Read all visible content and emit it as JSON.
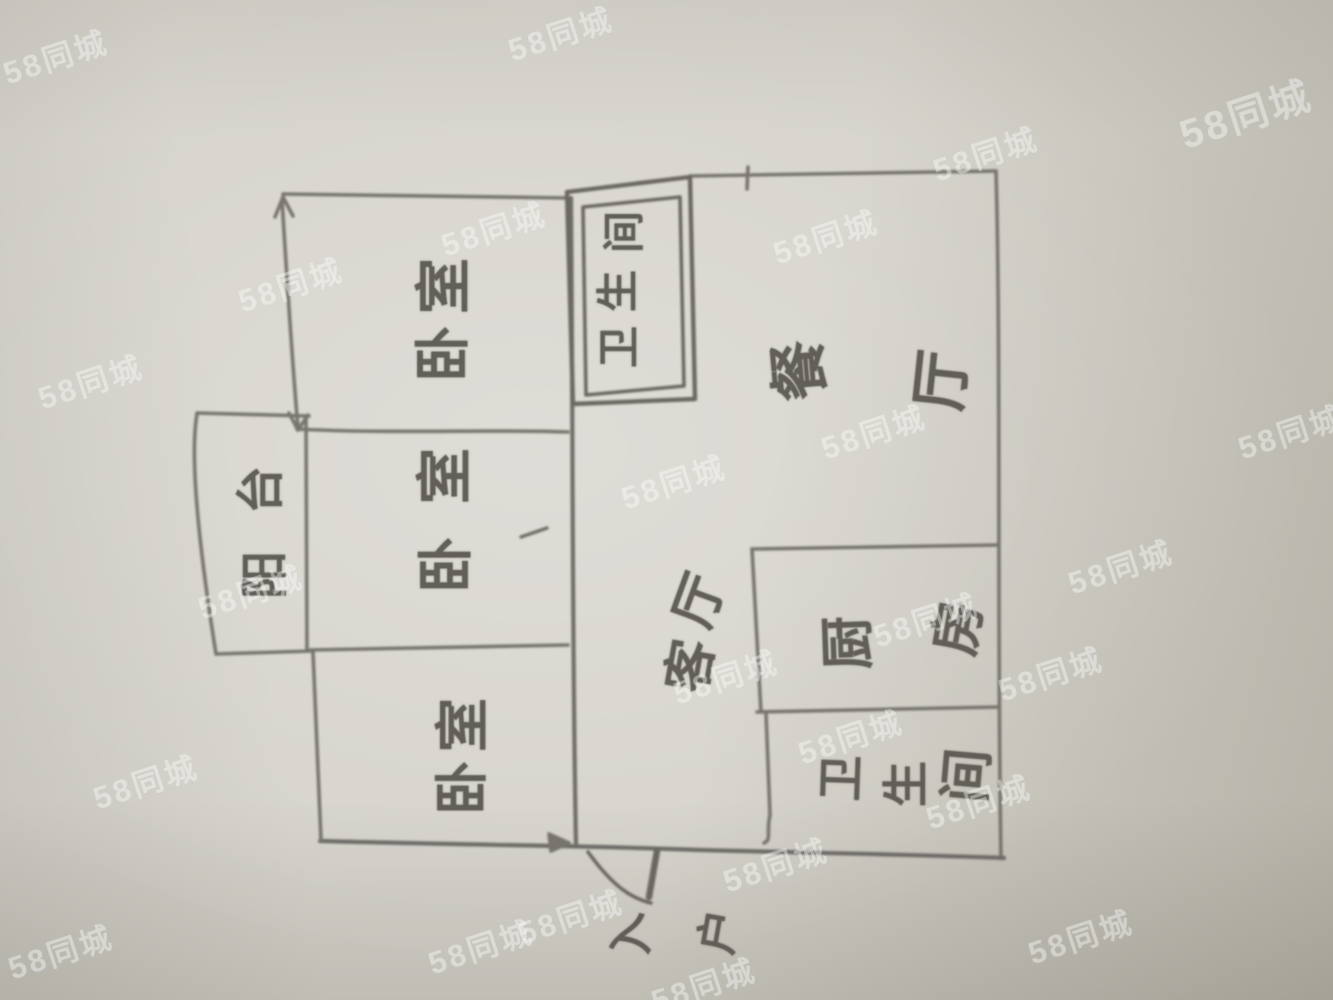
{
  "watermark": {
    "text": "58同城",
    "rotation_deg": -18,
    "default_size": 31,
    "color": "rgba(255,255,255,0.34)",
    "items": [
      {
        "x": 55,
        "y": 55
      },
      {
        "x": 560,
        "y": 32
      },
      {
        "x": 985,
        "y": 152
      },
      {
        "x": 1245,
        "y": 112,
        "s": 40
      },
      {
        "x": 493,
        "y": 227
      },
      {
        "x": 290,
        "y": 283
      },
      {
        "x": 825,
        "y": 235
      },
      {
        "x": 90,
        "y": 380
      },
      {
        "x": 873,
        "y": 430
      },
      {
        "x": 1290,
        "y": 430
      },
      {
        "x": 673,
        "y": 480
      },
      {
        "x": 925,
        "y": 618
      },
      {
        "x": 1120,
        "y": 565
      },
      {
        "x": 725,
        "y": 675
      },
      {
        "x": 250,
        "y": 590
      },
      {
        "x": 1050,
        "y": 672
      },
      {
        "x": 145,
        "y": 780
      },
      {
        "x": 850,
        "y": 735
      },
      {
        "x": 978,
        "y": 800
      },
      {
        "x": 775,
        "y": 863
      },
      {
        "x": 480,
        "y": 945
      },
      {
        "x": 570,
        "y": 915
      },
      {
        "x": 703,
        "y": 983
      },
      {
        "x": 60,
        "y": 950
      },
      {
        "x": 1080,
        "y": 935
      }
    ]
  },
  "floorplan": {
    "labels": [
      {
        "id": "bedroom-top",
        "text": "卧室",
        "x": 439,
        "y": 318,
        "font": 56,
        "chars": [
          {
            "c": "卧",
            "dx": 0,
            "dy": 36
          },
          {
            "c": "室",
            "dx": 1,
            "dy": -32
          }
        ]
      },
      {
        "id": "bedroom-middle",
        "text": "卧室",
        "x": 441,
        "y": 520,
        "font": 56,
        "chars": [
          {
            "c": "卧",
            "dx": 1,
            "dy": 45
          },
          {
            "c": "室",
            "dx": 0,
            "dy": -44
          }
        ]
      },
      {
        "id": "bedroom-bottom",
        "text": "卧室",
        "x": 457,
        "y": 756,
        "font": 54,
        "chars": [
          {
            "c": "卧",
            "dx": 0,
            "dy": 32
          },
          {
            "c": "室",
            "dx": 1,
            "dy": -31
          }
        ]
      },
      {
        "id": "balcony",
        "text": "阳台",
        "x": 258,
        "y": 532,
        "font": 48,
        "chars": [
          {
            "c": "阳",
            "dx": 2,
            "dy": 43
          },
          {
            "c": "台",
            "dx": -2,
            "dy": -42
          }
        ]
      },
      {
        "id": "bathroom-top",
        "text": "卫生间",
        "x": 617,
        "y": 290,
        "font": 42,
        "chars": [
          {
            "c": "卫",
            "dx": -1,
            "dy": 57
          },
          {
            "c": "生",
            "dx": -2,
            "dy": 1
          },
          {
            "c": "间",
            "dx": 4,
            "dy": -58
          }
        ]
      },
      {
        "id": "dining",
        "text": "餐厅",
        "x": 866,
        "y": 375,
        "font": 60,
        "chars": [
          {
            "c": "餐",
            "dx": -71,
            "dy": -4,
            "r": -95
          },
          {
            "c": "厅",
            "dx": 71,
            "dy": 5,
            "r": -84
          }
        ]
      },
      {
        "id": "living",
        "text": "客厅",
        "x": 690,
        "y": 632,
        "font": 52,
        "chars": [
          {
            "c": "客",
            "dx": -4,
            "dy": 33,
            "r": -80
          },
          {
            "c": "厅",
            "dx": 5,
            "dy": -33,
            "r": -70
          }
        ]
      },
      {
        "id": "kitchen",
        "text": "厨房",
        "x": 897,
        "y": 637,
        "font": 54,
        "chars": [
          {
            "c": "厨",
            "dx": -54,
            "dy": 6,
            "r": -92
          },
          {
            "c": "房",
            "dx": 56,
            "dy": -10,
            "r": -80
          }
        ]
      },
      {
        "id": "bathroom-bottom",
        "text": "卫生间",
        "x": 900,
        "y": 777,
        "font": 46,
        "chars": [
          {
            "c": "卫",
            "dx": -62,
            "dy": 1,
            "r": -88
          },
          {
            "c": "生",
            "dx": 3,
            "dy": 7,
            "r": -90
          },
          {
            "c": "间",
            "dx": 62,
            "dy": -2,
            "r": -85,
            "s": 54
          }
        ]
      },
      {
        "id": "entry",
        "text": "入户",
        "x": 670,
        "y": 933,
        "font": 44,
        "chars": [
          {
            "c": "入",
            "dx": -45,
            "dy": 4,
            "r": -100
          },
          {
            "c": "户",
            "dx": 45,
            "dy": -2,
            "r": -80
          }
        ]
      }
    ]
  }
}
